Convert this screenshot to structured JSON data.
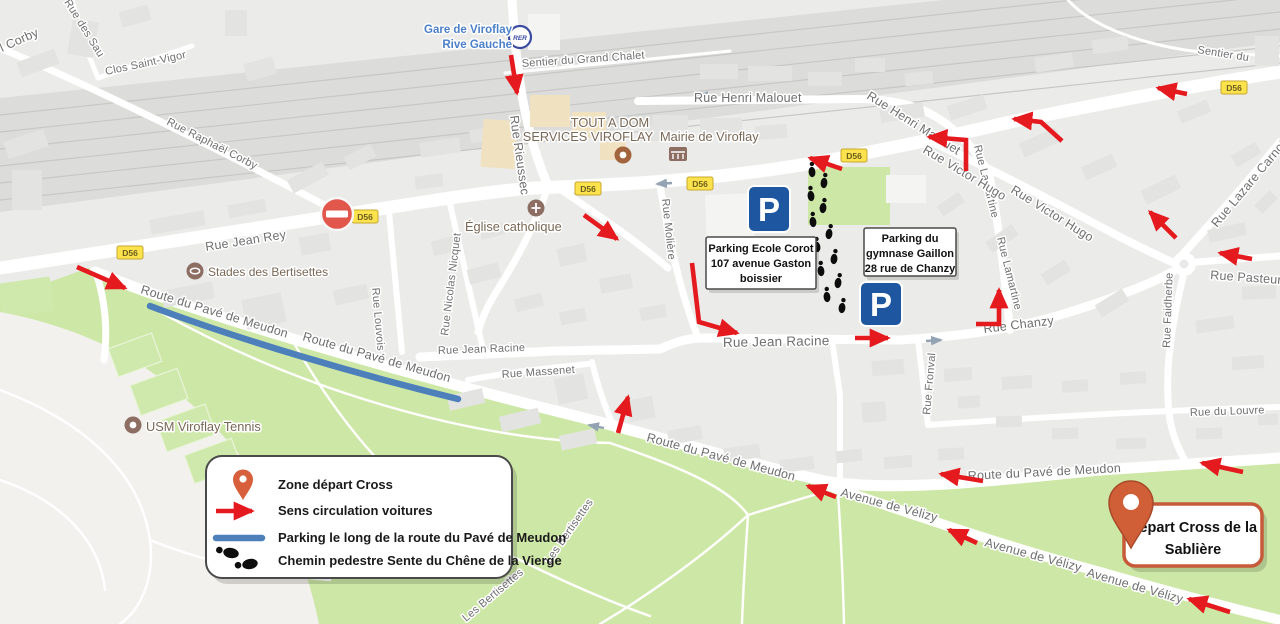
{
  "streets": {
    "corby": "l Corby",
    "des_sau": "Rue des Sau",
    "clos": "Clos Saint-Vigor",
    "raphael": "Rue Raphaël Corby",
    "grand_chalet": "Sentier du Grand Chalet",
    "malouet": "Rue Henri Malouet",
    "rieussec": "Rue Rieussec",
    "jean_rey": "Rue Jean Rey",
    "louvois": "Rue Louvois",
    "nicquet": "Rue Nicolas Nicquet",
    "moliere": "Rue Molière",
    "racine": "Rue Jean Racine",
    "massenet": "Rue Massenet",
    "lamartine": "Rue Lamartine",
    "fronval": "Rue Fronval",
    "victor_hugo": "Rue Victor Hugo",
    "carnot": "Rue Lazare Carnot",
    "sentier_du": "Sentier du",
    "pasteur": "Rue Pasteur",
    "faidherbe": "Rue Faidherbe",
    "chanzy": "Rue Chanzy",
    "louvre": "Rue du Louvre",
    "route_pave": "Route du Pavé de Meudon",
    "velizy": "Avenue de Vélizy",
    "bertisettes": "Les Bertisettes",
    "d56": "D56"
  },
  "pois": {
    "station1": "Gare de Viroflay",
    "station2": "Rive Gauche",
    "rer": "RER",
    "tout1": "TOUT A DOM",
    "tout2": "SERVICES VIROFLAY",
    "mairie": "Mairie de Viroflay",
    "eglise": "Église catholique",
    "stades": "Stades des Bertisettes",
    "tennis": "USM Viroflay Tennis",
    "parking_letter": "P"
  },
  "annotations": {
    "corot": {
      "l1": "Parking Ecole Corot",
      "l2": "107 avenue Gaston",
      "l3": "boissier"
    },
    "gaillon": {
      "l1": "Parking du",
      "l2": "gymnase Gaillon",
      "l3": "28 rue de Chanzy"
    },
    "depart": {
      "l1": "Départ Cross de la",
      "l2": "Sablière"
    },
    "legend": {
      "zone": "Zone départ Cross",
      "sens": "Sens circulation voitures",
      "parking": "Parking le long de la route du Pavé de Meudon",
      "chemin": "Chemin pedestre Sente du Chêne de la Vierge"
    }
  },
  "colors": {
    "arrow_red": "#e41a1f",
    "parking_line_blue": "#4d7fba",
    "pin_orange": "#d05f38",
    "parking_icon_blue": "#1e56a0",
    "badge_yellow": "#fce24c",
    "no_entry_red": "#e2574c",
    "park_green": "#cde8a6"
  }
}
